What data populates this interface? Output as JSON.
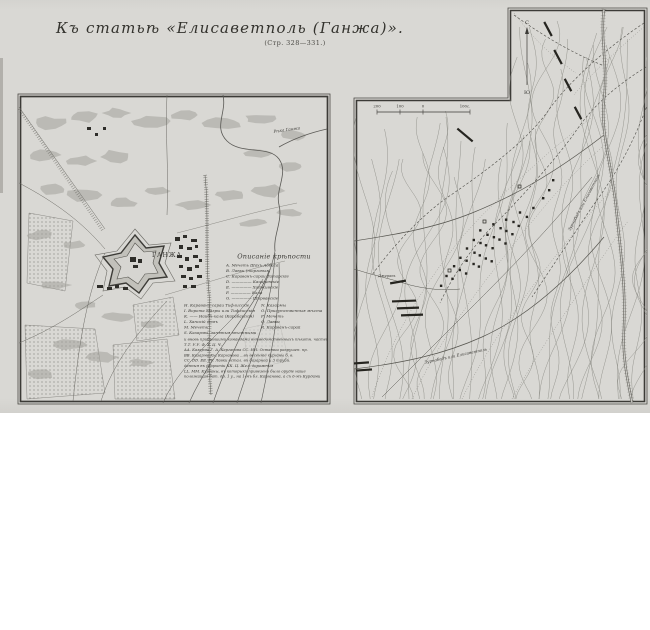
{
  "page": {
    "title": "Къ статьѣ «Елисаветполь (Ганжа)».",
    "subtitle": "(Стр. 328—331.)"
  },
  "colors": {
    "paper": "#d9d8d4",
    "ink": "#3c3b37",
    "contour": "#8f8e88",
    "garden": "#a3a29c"
  },
  "left_map": {
    "city_label": "ГАНЖА",
    "river_label": "Рѣка Ганжа",
    "legend": {
      "heading": "Описаніе крѣпости",
      "items_top": [
        "А. Мечеть Шахъ-Аббаса",
        "В. Лавки (торговыя)",
        "С. Караванъ-сараи Татарскіе",
        "D. ————— Кацаревскіе",
        "Е. ————— Хадживскіе",
        "F. ————— Кала",
        "G. ————— Ширванскіе"
      ],
      "items_left": [
        "Н. Караванъ-сараи Тифлисскіе",
        "I. Ворота Мазры или Тифлисскія",
        "К. —— Наибъ-кала (Карабахскія)",
        "L. Ханскій домъ",
        "М. Мечеть",
        "S. Казармы, занятыя мѣстными"
      ],
      "items_right": [
        "N. Казармы",
        "О. Присутственныя мѣста",
        "Р. Мечеть",
        "Q. Лавки",
        "R. Караванъ-сарай"
      ],
      "notes": [
        "и вновь прибывшими командами внѣведомственныхъ пѣхотн. частей.",
        "Т.Т.   У.У.   Ф.   Х.   Ц.   Ч.",
        "АА. Казарма Г. А. Карганова      СС. НН. Остатки разрушен. пр.",
        "ВВ. Казарма Кн. Карганова      ...въ весенніе курганы б. в.",
        "СС. DD. ЕЕ. FF. Лавки остал.      въ базарной и 3 трубъ.",
        "данныя въ разрытіи      КК. Ц. Жел.-дорожныя",
        "LL. ММ. Курганы, въ которыхъ привезено было орудіе наше",
        "положащая бат. др. 1 у., на 1-мъ бл. Карганова, а съ 6-мъ Курдами"
      ]
    }
  },
  "right_map": {
    "compass_north": "С",
    "compass_south": "Ю",
    "scale_labels": [
      "200",
      "100",
      "0",
      "100с."
    ],
    "road_label_upper": "Зурнабадъ или Елисаветполь",
    "road_label_lower": "Зурнабадъ или Елисаветполь",
    "stream_label": "Джерань"
  }
}
